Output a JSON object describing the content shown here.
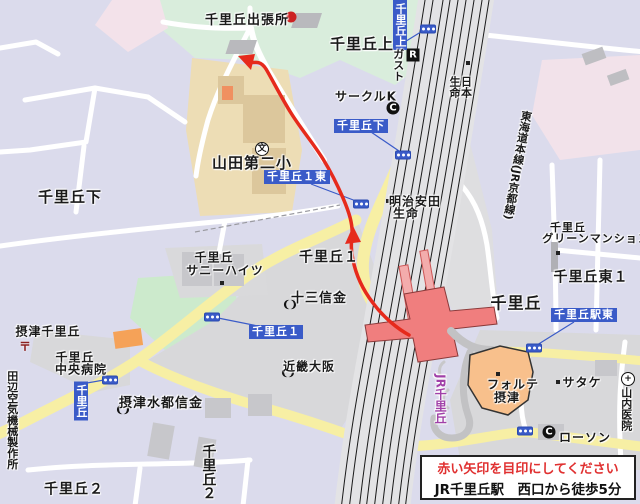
{
  "labels": {
    "branch_office": "千里丘出張所",
    "senrioka_kami_black": "千里丘上",
    "gusto": "ガスト",
    "circle_k": "サークルK",
    "nippon_life_right": "日本",
    "nippon_life_left": "生命",
    "senrioka_shimo_big": "千里丘下",
    "yamada_elementary": "山田第二小",
    "sunny_heights_line1": "千里丘",
    "sunny_heights_line2": "サニーハイツ",
    "senrioka_1_black": "千里丘１",
    "juso_shinkin": "十三信金",
    "meiji_line1": "明治安田",
    "meiji_line2": "生命",
    "senrioka_east_big": "千里丘",
    "senrioka_higashi_1": "千里丘東１",
    "green_mansion_line1": "千里丘",
    "green_mansion_line2": "グリーンマンション",
    "settsu_senrioka": "摂津千里丘",
    "hospital_line1": "千里丘",
    "hospital_line2": "中央病院",
    "suito_shinkin": "摂津水都信金",
    "kinki_osaka": "近畿大阪",
    "tanabe_factory": "田辺空気機械製作所",
    "senrioka_2_a": "千里丘２",
    "senrioka_2_b": "千里丘２",
    "forte_line1": "フォルテ",
    "forte_line2": "摂津",
    "satake": "サタケ",
    "lawson": "ローソン",
    "yamauchi_clinic": "山内医院",
    "jr_station": "JR千里丘",
    "tokaido_line": "東海道本線(JR京都線)"
  },
  "signal_labels": {
    "kami": "千里丘上",
    "shimo": "千里丘下",
    "ichi_higashi": "千里丘１東",
    "ichi": "千里丘１",
    "senrioka": "千里丘",
    "eki_higashi": "千里丘駅東"
  },
  "icons": {
    "restaurant": "R",
    "convenience_1": "C",
    "convenience_2": "C",
    "school": "文",
    "hospital": "+",
    "post": "〒"
  },
  "info_box": {
    "line1": "赤い矢印を目印にしてください",
    "line2": "JR千里丘駅　西口から徒歩5分"
  },
  "colors": {
    "route_red": "#E62A1C",
    "signal_blue": "#3A5BC8",
    "station_red": "#F07E7E",
    "forte_orange": "#F8C08C",
    "road_yellow": "#F7EFA4",
    "rail_line": "#1a1a1a",
    "station_text_purple": "#A040A8"
  }
}
